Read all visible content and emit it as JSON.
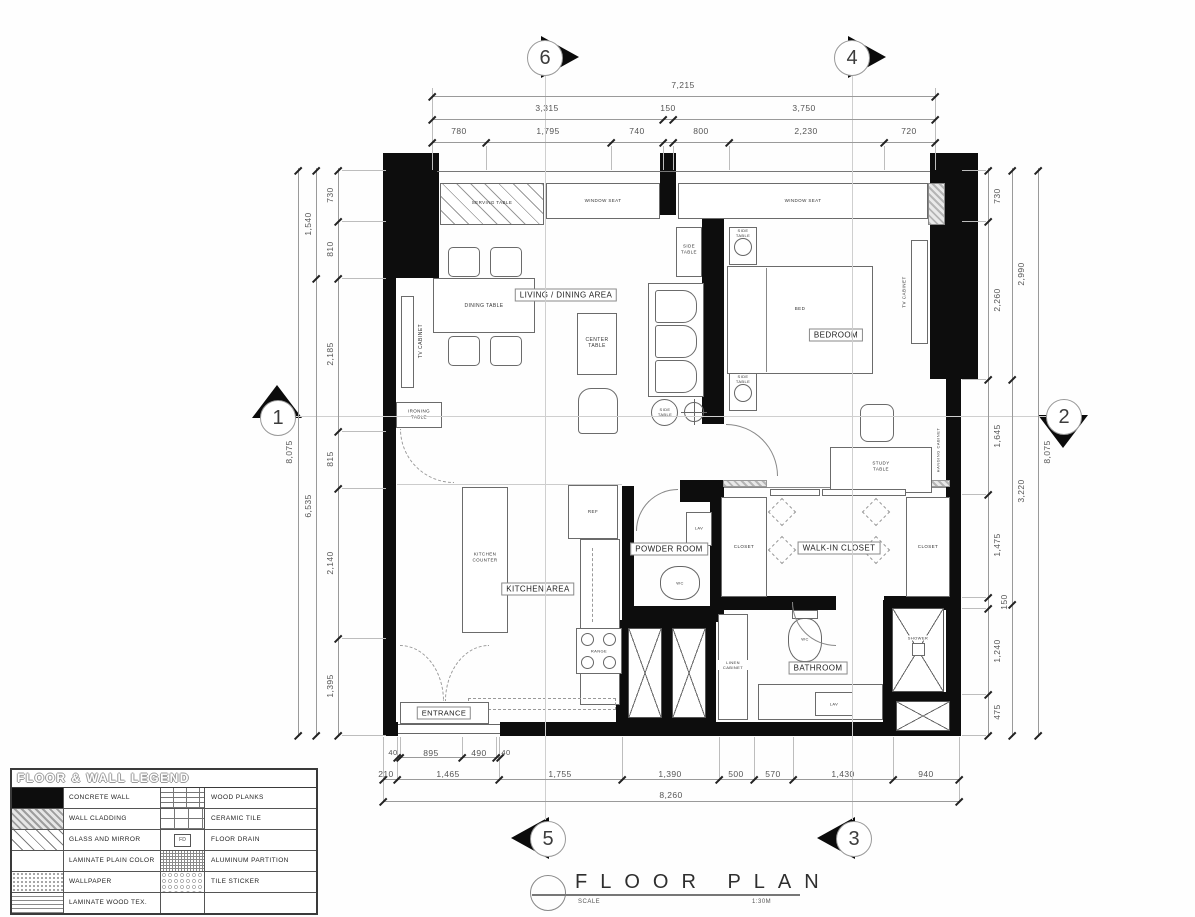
{
  "grid": {
    "g6": "6",
    "g4": "4",
    "g1": "1",
    "g2": "2",
    "g5": "5",
    "g3": "3"
  },
  "dims": {
    "top_overall": "7,215",
    "top_mid": [
      "3,315",
      "150",
      "3,750"
    ],
    "top_inner": [
      "780",
      "1,795",
      "740",
      "800",
      "2,230",
      "720"
    ],
    "left_outer": "8,075",
    "left_mid": [
      "1,540",
      "6,535"
    ],
    "left_inner": [
      "730",
      "810",
      "2,185",
      "815",
      "2,140",
      "1,395"
    ],
    "right_outer": "8,075",
    "right_mid": [
      "2,990",
      "3,220"
    ],
    "right_inner": [
      "730",
      "2,260",
      "1,645",
      "1,475",
      "150",
      "1,240",
      "475"
    ],
    "bottom_door": [
      "40",
      "895",
      "490",
      "40"
    ],
    "bottom_inner": [
      "210",
      "1,465",
      "1,755",
      "1,390",
      "500",
      "570",
      "1,430",
      "940"
    ],
    "bottom_overall": "8,260"
  },
  "rooms": {
    "living": "LIVING / DINING AREA",
    "bedroom": "BEDROOM",
    "powder": "POWDER ROOM",
    "walkin": "WALK-IN CLOSET",
    "kitchen": "KITCHEN AREA",
    "bathroom": "BATHROOM",
    "entrance": "ENTRANCE"
  },
  "furniture": {
    "serving_table": "SERVING TABLE",
    "window_seat": "WINDOW SEAT",
    "side_table": "SIDE TABLE",
    "dining_table": "DINING TABLE",
    "center_table": "CENTER TABLE",
    "tv_cabinet": "TV CABINET",
    "ironing_table": "IRONING TABLE",
    "bed": "BED",
    "study_table": "STUDY TABLE",
    "hanging_cabinet": "HANGING CABINET",
    "kitchen_counter": "KITCHEN COUNTER",
    "ref": "REF",
    "range": "RANGE",
    "closet": "CLOSET",
    "linen_cabinet": "LINEN CABINET",
    "wc": "WC",
    "lav": "LAV",
    "shower": "SHOWER"
  },
  "legend": {
    "title": "FLOOR & WALL LEGEND",
    "left": [
      "CONCRETE WALL",
      "WALL CLADDING",
      "GLASS AND MIRROR",
      "LAMINATE PLAIN COLOR",
      "WALLPAPER",
      "LAMINATE WOOD TEX."
    ],
    "right": [
      "WOOD PLANKS",
      "CERAMIC TILE",
      "FLOOR DRAIN",
      "ALUMINUM PARTITION",
      "TILE STICKER"
    ],
    "fd_text": "FD"
  },
  "title_block": {
    "title": "FLOOR PLAN",
    "scale_label": "SCALE",
    "scale_value": "1:30M"
  },
  "colors": {
    "wall": "#0d0d0d",
    "dim_line": "#999999",
    "grid_line": "#c8c8c8"
  }
}
